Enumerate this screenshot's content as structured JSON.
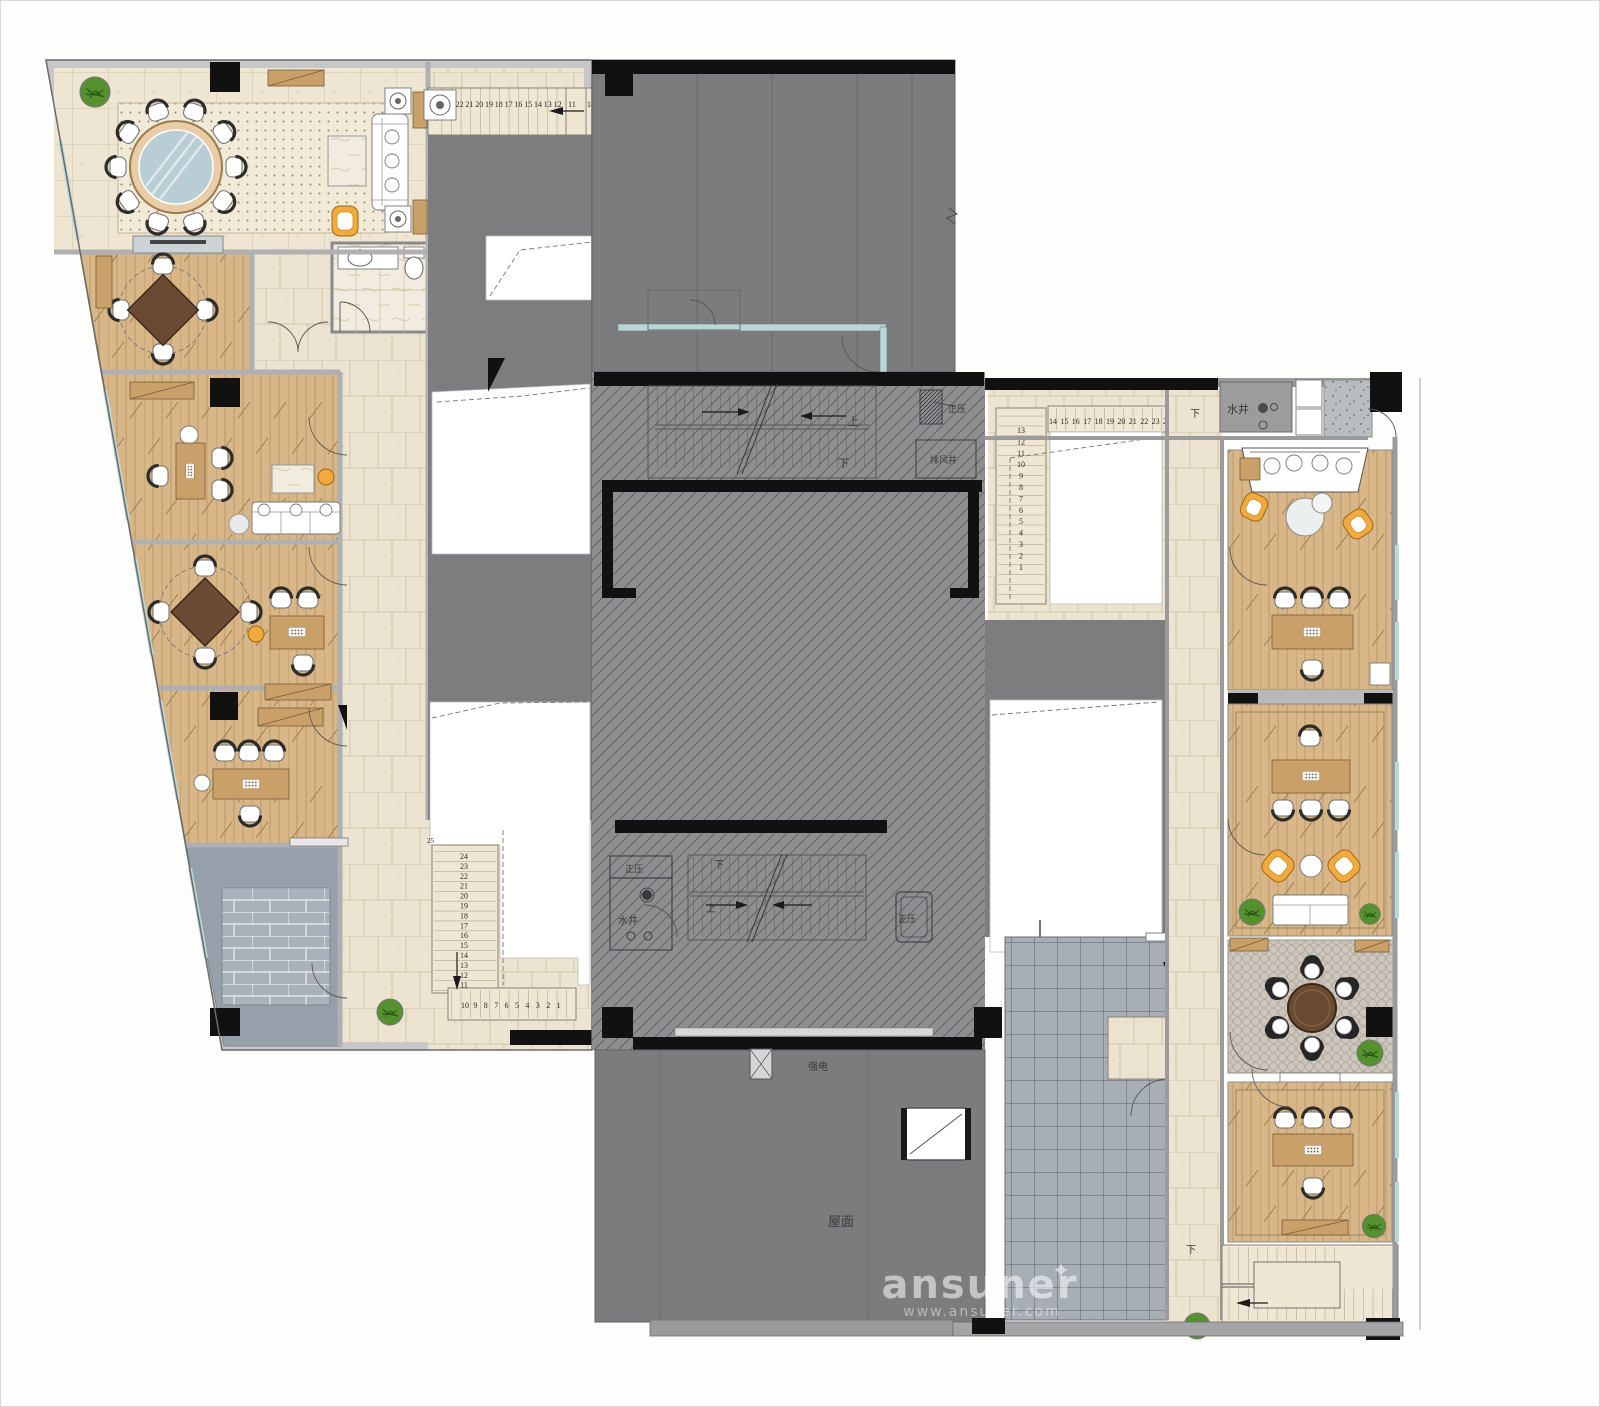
{
  "plan": {
    "labels": {
      "up": "上",
      "down": "下",
      "water_well": "水井",
      "positive_pressure": "正压",
      "exhaust_shaft": "排风井",
      "strong_electric": "强电",
      "roof": "屋面"
    },
    "stairs": {
      "top_run": [
        "24",
        "23",
        "22",
        "21",
        "20",
        "19",
        "18",
        "17",
        "16",
        "15",
        "14",
        "13",
        "12"
      ],
      "top_landing": [
        "11",
        "10"
      ],
      "left_vertical": [
        "24",
        "23",
        "22",
        "21",
        "20",
        "19",
        "18",
        "17",
        "16",
        "15",
        "14",
        "13",
        "12",
        "11"
      ],
      "left_horizontal": [
        "10",
        "9",
        "8",
        "7",
        "6",
        "5",
        "4",
        "3",
        "2",
        "1"
      ],
      "left_corner_mark": "25",
      "right_vertical": [
        "13",
        "12",
        "11",
        "10",
        "9",
        "8",
        "7",
        "6",
        "5",
        "4",
        "3",
        "2",
        "1"
      ],
      "right_horizontal": [
        "14",
        "15",
        "16",
        "17",
        "18",
        "19",
        "20",
        "21",
        "22",
        "23",
        "24",
        "25"
      ]
    },
    "watermark": {
      "brand": "ansuner",
      "star": "✦",
      "url": "www.ansuner.com"
    },
    "colors": {
      "roof_gray": "#7c7c7e",
      "core_gray": "#8e8e90",
      "tile_beige": "#ece4d1",
      "wood": "#d8b687",
      "terrace_blue_gray": "#96a0ab",
      "accent_yellow": "#f2a93d",
      "wall_black": "#111111"
    }
  }
}
